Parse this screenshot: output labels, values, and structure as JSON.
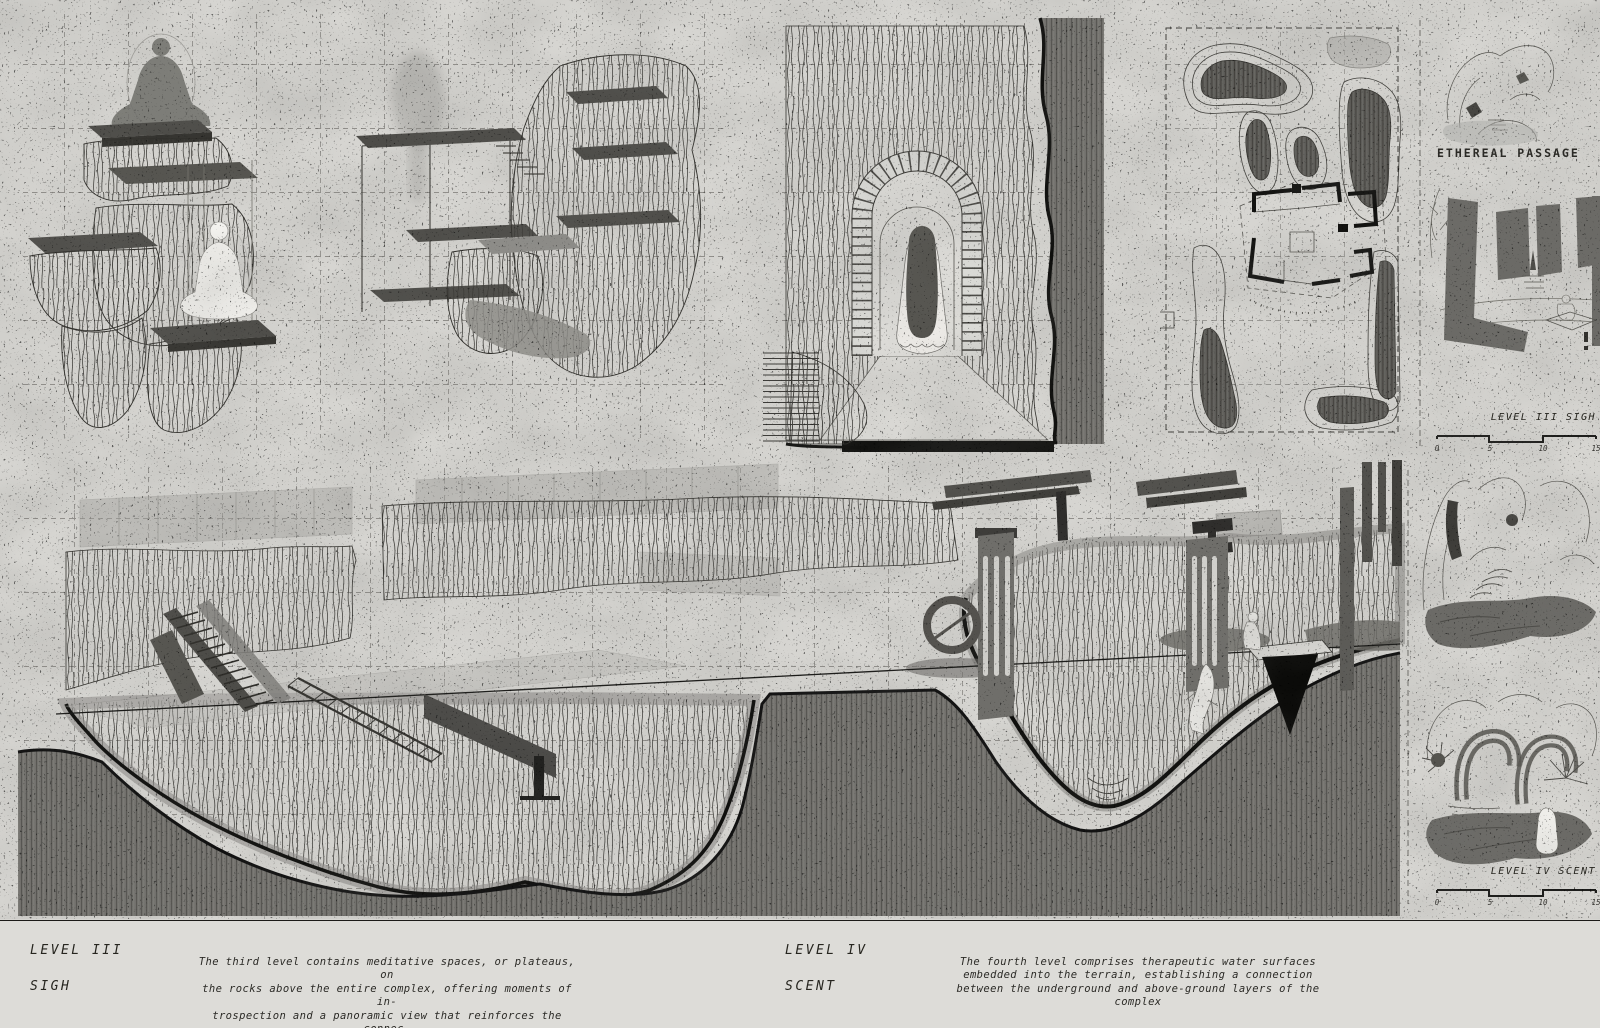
{
  "palette": {
    "paper": "#d6d5d1",
    "paper_footer": "#dddcd8",
    "ink": "#2f2e2a",
    "hatch_gray": "#716f6b",
    "dark_mass": "#6f6e6a",
    "black_edge": "#0e0e0c"
  },
  "captions": {
    "ethereal": "ETHEREAL PASSAGE"
  },
  "scales": {
    "level3": {
      "label": "LEVEL III SIGH",
      "ticks": [
        "0",
        "5",
        "10",
        "15"
      ]
    },
    "level4": {
      "label": "LEVEL IV SCENT",
      "ticks": [
        "0",
        "5",
        "10",
        "15"
      ]
    }
  },
  "footer": {
    "level3": {
      "title": "LEVEL III",
      "subtitle": "SIGH",
      "body": "The third level contains meditative spaces, or plateaus, on\nthe rocks above the entire complex, offering moments of in-\ntrospection and a panoramic view that reinforces the connec-\ntion between the individual and the surrounding landscape"
    },
    "level4": {
      "title": "LEVEL IV",
      "subtitle": "SCENT",
      "body": "The fourth level comprises therapeutic water surfaces\nembedded into the terrain, establishing a connection\nbetween the underground and above-ground layers of the\ncomplex"
    }
  }
}
